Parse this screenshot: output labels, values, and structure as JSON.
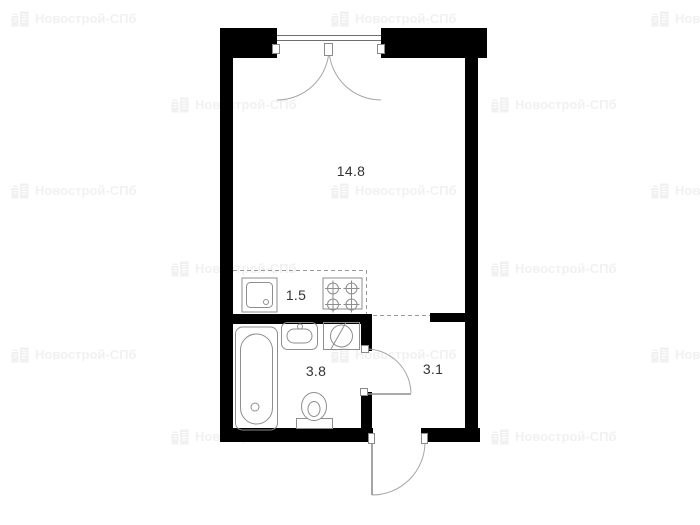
{
  "watermark": {
    "text": "Новострой-СПб",
    "color": "#f1f1f1",
    "icon": "building-icon",
    "positions": [
      {
        "x": 10,
        "y": 8
      },
      {
        "x": 330,
        "y": 8
      },
      {
        "x": 650,
        "y": 8
      },
      {
        "x": 170,
        "y": 94
      },
      {
        "x": 490,
        "y": 94
      },
      {
        "x": 10,
        "y": 180
      },
      {
        "x": 330,
        "y": 180
      },
      {
        "x": 650,
        "y": 180
      },
      {
        "x": 170,
        "y": 258
      },
      {
        "x": 490,
        "y": 258
      },
      {
        "x": 10,
        "y": 344
      },
      {
        "x": 330,
        "y": 344
      },
      {
        "x": 650,
        "y": 344
      },
      {
        "x": 170,
        "y": 426
      },
      {
        "x": 490,
        "y": 426
      }
    ]
  },
  "plan": {
    "type": "studio-apartment-floor-plan",
    "wall_color": "#000000",
    "line_color": "#8e8e8e",
    "label_color": "#333333",
    "rooms": [
      {
        "id": "living-room",
        "area": "14.8"
      },
      {
        "id": "kitchen-niche",
        "area": "1.5"
      },
      {
        "id": "bathroom",
        "area": "3.8"
      },
      {
        "id": "hallway",
        "area": "3.1"
      }
    ],
    "fixtures": [
      "kitchen-sink-icon",
      "stove-burners-icon",
      "bathtub-icon",
      "washbasin-icon",
      "washing-machine-icon",
      "toilet-icon"
    ],
    "doors": [
      "balcony-double-door",
      "bathroom-door",
      "entrance-door"
    ]
  }
}
